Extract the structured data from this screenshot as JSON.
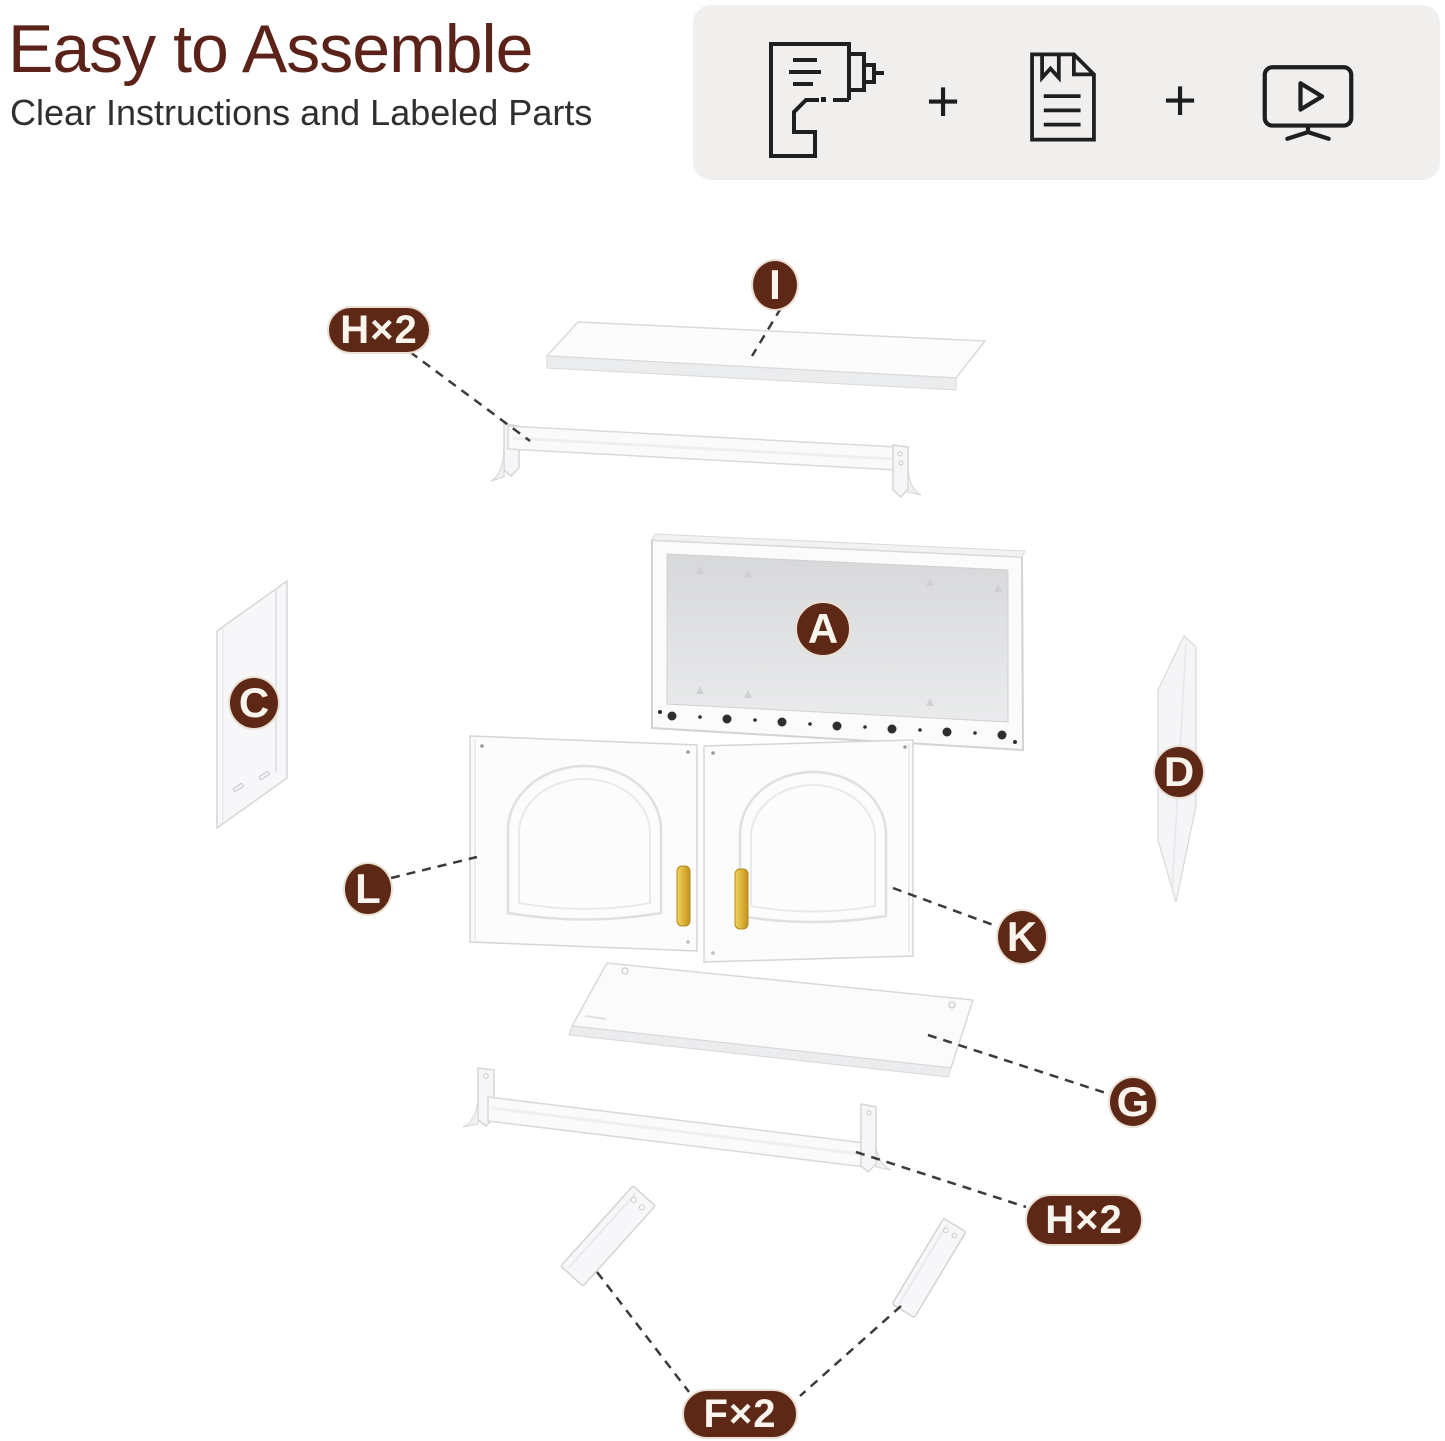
{
  "header": {
    "title": "Easy to Assemble",
    "subtitle": "Clear Instructions and Labeled Parts"
  },
  "support_card": {
    "plus": "+",
    "icons": [
      "drill-icon",
      "instruction-manual-icon",
      "video-tutorial-icon"
    ]
  },
  "badges": [
    {
      "id": "I",
      "label": "I",
      "shape": "circle"
    },
    {
      "id": "H2-top",
      "label": "H×2",
      "shape": "pill"
    },
    {
      "id": "A",
      "label": "A",
      "shape": "circle"
    },
    {
      "id": "C",
      "label": "C",
      "shape": "circle"
    },
    {
      "id": "D",
      "label": "D",
      "shape": "circle"
    },
    {
      "id": "L",
      "label": "L",
      "shape": "circle"
    },
    {
      "id": "K",
      "label": "K",
      "shape": "circle"
    },
    {
      "id": "G",
      "label": "G",
      "shape": "circle"
    },
    {
      "id": "H2-bottom",
      "label": "H×2",
      "shape": "pill"
    },
    {
      "id": "F2",
      "label": "F×2",
      "shape": "pill"
    }
  ],
  "colors": {
    "badge_brown": "#5e2817",
    "title_maroon": "#5b2219",
    "card_bg": "#f0efed",
    "leader_line": "#3b3b3b",
    "part_fill": "#fbfbfc",
    "part_edge": "#d5d6d8",
    "handle_gold": "#d9a927"
  }
}
